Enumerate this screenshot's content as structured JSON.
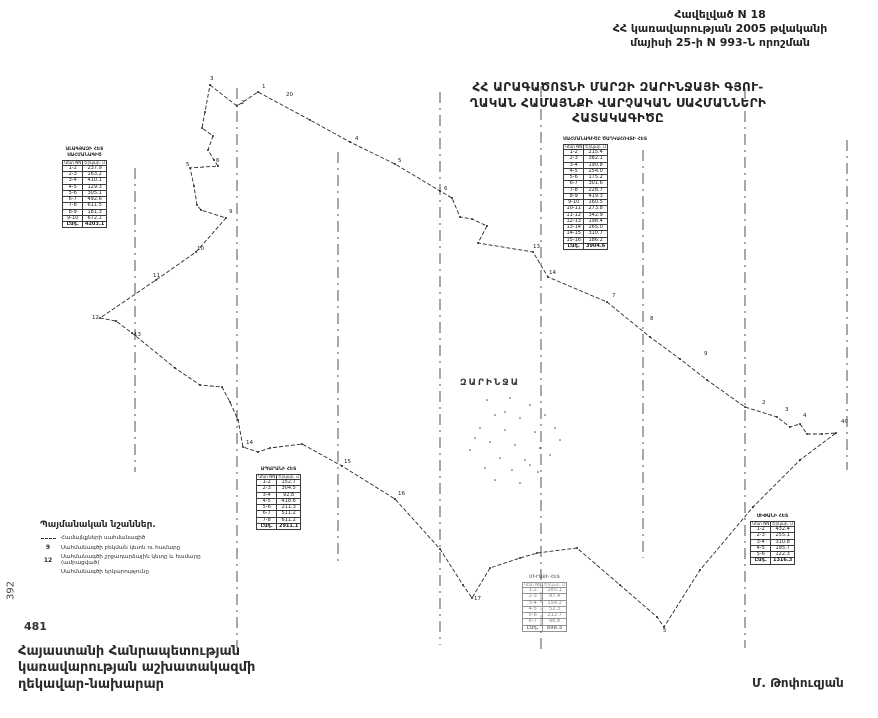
{
  "annex": {
    "line1": "Հավելված N  18",
    "line2": "ՀՀ կառավարության 2005 թվականի",
    "line3": "մայիսի 25-ի N 993-Ն որոշման"
  },
  "title": {
    "line1": "ՀՀ ԱՐԱԳԱԾՈՏՆԻ ՄԱՐԶԻ ԶԱՐԻՆՋԱՅԻ ԳՅՈՒ-",
    "line2": "ՂԱԿԱՆ ՀԱՄԱՅՆՔԻ ՎԱՐՉԱԿԱՆ ՍԱՀՄԱՆՆԵՐԻ",
    "line3": "ՀԱՏԱԿԱԳԻԾԸ"
  },
  "map": {
    "place_label": "ԶԱՐԻՆՋԱ",
    "ink": "#2a2a2a",
    "boundary": [
      [
        210,
        85
      ],
      [
        237,
        106
      ],
      [
        258,
        92
      ],
      [
        310,
        120
      ],
      [
        350,
        142
      ],
      [
        395,
        164
      ],
      [
        440,
        191
      ],
      [
        452,
        198
      ],
      [
        460,
        217
      ],
      [
        472,
        219
      ],
      [
        487,
        226
      ],
      [
        478,
        243
      ],
      [
        533,
        252
      ],
      [
        548,
        277
      ],
      [
        607,
        302
      ],
      [
        650,
        337
      ],
      [
        680,
        359
      ],
      [
        707,
        380
      ],
      [
        745,
        407
      ],
      [
        777,
        417
      ],
      [
        790,
        427
      ],
      [
        800,
        424
      ],
      [
        807,
        434
      ],
      [
        822,
        434
      ],
      [
        836,
        433
      ],
      [
        800,
        460
      ],
      [
        753,
        507
      ],
      [
        700,
        570
      ],
      [
        664,
        627
      ],
      [
        657,
        617
      ],
      [
        620,
        585
      ],
      [
        577,
        548
      ],
      [
        537,
        553
      ],
      [
        520,
        558
      ],
      [
        490,
        568
      ],
      [
        472,
        598
      ],
      [
        463,
        585
      ],
      [
        440,
        549
      ],
      [
        395,
        499
      ],
      [
        342,
        466
      ],
      [
        302,
        444
      ],
      [
        270,
        448
      ],
      [
        258,
        452
      ],
      [
        243,
        447
      ],
      [
        238,
        420
      ],
      [
        230,
        402
      ],
      [
        222,
        387
      ],
      [
        200,
        385
      ],
      [
        175,
        368
      ],
      [
        132,
        333
      ],
      [
        116,
        321
      ],
      [
        100,
        318
      ],
      [
        156,
        280
      ],
      [
        196,
        252
      ],
      [
        226,
        218
      ],
      [
        201,
        210
      ],
      [
        197,
        205
      ],
      [
        194,
        186
      ],
      [
        190,
        168
      ],
      [
        218,
        166
      ],
      [
        214,
        160
      ],
      [
        208,
        150
      ],
      [
        213,
        136
      ],
      [
        202,
        128
      ],
      [
        205,
        112
      ],
      [
        210,
        85
      ]
    ],
    "points": [
      {
        "x": 210,
        "y": 80,
        "l": "3"
      },
      {
        "x": 241,
        "y": 104,
        "l": "2"
      },
      {
        "x": 262,
        "y": 88,
        "l": "1"
      },
      {
        "x": 286,
        "y": 96,
        "l": "20"
      },
      {
        "x": 355,
        "y": 140,
        "l": "4"
      },
      {
        "x": 398,
        "y": 162,
        "l": "5"
      },
      {
        "x": 444,
        "y": 190,
        "l": "6"
      },
      {
        "x": 533,
        "y": 248,
        "l": "13"
      },
      {
        "x": 549,
        "y": 274,
        "l": "14"
      },
      {
        "x": 612,
        "y": 297,
        "l": "7"
      },
      {
        "x": 650,
        "y": 320,
        "l": "8"
      },
      {
        "x": 704,
        "y": 355,
        "l": "9"
      },
      {
        "x": 762,
        "y": 404,
        "l": "2"
      },
      {
        "x": 785,
        "y": 411,
        "l": "3"
      },
      {
        "x": 803,
        "y": 417,
        "l": "4"
      },
      {
        "x": 841,
        "y": 423,
        "l": "40"
      },
      {
        "x": 216,
        "y": 162,
        "l": "6"
      },
      {
        "x": 186,
        "y": 166,
        "l": "5"
      },
      {
        "x": 229,
        "y": 213,
        "l": "9"
      },
      {
        "x": 197,
        "y": 250,
        "l": "10"
      },
      {
        "x": 153,
        "y": 277,
        "l": "11"
      },
      {
        "x": 92,
        "y": 319,
        "l": "12"
      },
      {
        "x": 134,
        "y": 336,
        "l": "13"
      },
      {
        "x": 246,
        "y": 444,
        "l": "14"
      },
      {
        "x": 344,
        "y": 463,
        "l": "15"
      },
      {
        "x": 398,
        "y": 495,
        "l": "16"
      },
      {
        "x": 474,
        "y": 600,
        "l": "17"
      },
      {
        "x": 663,
        "y": 632,
        "l": "5"
      }
    ],
    "fold_lines": [
      {
        "x": 135,
        "y1": 168,
        "y2": 472
      },
      {
        "x": 237,
        "y1": 88,
        "y2": 648
      },
      {
        "x": 338,
        "y1": 152,
        "y2": 562
      },
      {
        "x": 440,
        "y1": 92,
        "y2": 645
      },
      {
        "x": 541,
        "y1": 86,
        "y2": 650
      },
      {
        "x": 643,
        "y1": 150,
        "y2": 558
      },
      {
        "x": 745,
        "y1": 88,
        "y2": 648
      },
      {
        "x": 847,
        "y1": 140,
        "y2": 470
      }
    ],
    "settlement_dots": [
      [
        487,
        400
      ],
      [
        510,
        398
      ],
      [
        530,
        405
      ],
      [
        495,
        415
      ],
      [
        520,
        418
      ],
      [
        545,
        415
      ],
      [
        480,
        428
      ],
      [
        505,
        430
      ],
      [
        535,
        432
      ],
      [
        555,
        428
      ],
      [
        490,
        442
      ],
      [
        515,
        445
      ],
      [
        540,
        448
      ],
      [
        470,
        450
      ],
      [
        500,
        458
      ],
      [
        525,
        460
      ],
      [
        550,
        455
      ],
      [
        485,
        468
      ],
      [
        512,
        470
      ],
      [
        538,
        472
      ],
      [
        495,
        480
      ],
      [
        520,
        483
      ],
      [
        475,
        438
      ],
      [
        560,
        440
      ],
      [
        505,
        412
      ],
      [
        530,
        465
      ]
    ]
  },
  "tables": [
    {
      "x": 62,
      "y": 148,
      "title_lines": [
        "ԱԼԱԳՅԱԶԻ ՀԵՏ",
        "ՍԱՀՄԱՆԱԳԻԾ"
      ],
      "col1": "Կետ NN",
      "col2": "Երկար. մ",
      "faint": false,
      "rows": [
        [
          "1-2",
          "237.9"
        ],
        [
          "2-3",
          "163.2"
        ],
        [
          "3-4",
          "410.1"
        ],
        [
          "4-5",
          "129.3"
        ],
        [
          "5-6",
          "305.1"
        ],
        [
          "6-7",
          "492.6"
        ],
        [
          "7-8",
          "611.5"
        ],
        [
          "8-9",
          "181.3"
        ],
        [
          "9-10",
          "672.1"
        ]
      ],
      "total": [
        "Ընդ.",
        "4203.1"
      ]
    },
    {
      "x": 563,
      "y": 138,
      "title_lines": [
        "ՍԱՀՄԱՆԱԳԻԾԸ ԾԱՂԿԱՀՈՎՏԻ ՀԵՏ"
      ],
      "col1": "Կետ NN",
      "col2": "Երկար. մ",
      "faint": false,
      "rows": [
        [
          "1-2",
          "215.4"
        ],
        [
          "2-3",
          "382.1"
        ],
        [
          "3-4",
          "190.8"
        ],
        [
          "4-5",
          "254.0"
        ],
        [
          "5-6",
          "175.2"
        ],
        [
          "6-7",
          "301.6"
        ],
        [
          "7-8",
          "228.7"
        ],
        [
          "8-9",
          "419.3"
        ],
        [
          "9-10",
          "160.5"
        ],
        [
          "10-11",
          "273.8"
        ],
        [
          "11-12",
          "342.9"
        ],
        [
          "12-13",
          "198.4"
        ],
        [
          "13-14",
          "265.0"
        ],
        [
          "14-15",
          "310.7"
        ],
        [
          "15-16",
          "186.2"
        ]
      ],
      "total": [
        "Ընդ.",
        "3904.6"
      ]
    },
    {
      "x": 256,
      "y": 468,
      "title_lines": [
        "ԱՊԱՐԱՆԻ ՀԵՏ"
      ],
      "col1": "Կետ NN",
      "col2": "Երկար. մ",
      "faint": false,
      "rows": [
        [
          "1-2",
          "152.7"
        ],
        [
          "2-3",
          "304.5"
        ],
        [
          "3-4",
          "92.8"
        ],
        [
          "4-5",
          "418.6"
        ],
        [
          "5-6",
          "211.3"
        ],
        [
          "6-7",
          "511.2"
        ],
        [
          "7-8",
          "611.2"
        ]
      ],
      "total": [
        "Ընդ.",
        "2911.1"
      ]
    },
    {
      "x": 522,
      "y": 576,
      "title_lines": [
        "ՄԻՐԱՔԻ ՀԵՏ"
      ],
      "col1": "Կետ NN",
      "col2": "Երկար. մ",
      "faint": true,
      "rows": [
        [
          "1-2",
          "285.1"
        ],
        [
          "2-3",
          "97.4"
        ],
        [
          "3-4",
          "154.2"
        ],
        [
          "4-5",
          "52.3"
        ],
        [
          "5-6",
          "212.7"
        ],
        [
          "6-7",
          "96.8"
        ]
      ],
      "total": [
        "Ընդ.",
        "898.5"
      ]
    },
    {
      "x": 750,
      "y": 515,
      "title_lines": [
        "ՍԻՓԱՆԻ ՀԵՏ"
      ],
      "col1": "Կետ NN",
      "col2": "Երկար. մ",
      "faint": false,
      "rows": [
        [
          "1-2",
          "432.4"
        ],
        [
          "2-3",
          "255.1"
        ],
        [
          "3-4",
          "310.8"
        ],
        [
          "4-5",
          "195.7"
        ],
        [
          "5-6",
          "122.3"
        ]
      ],
      "total": [
        "Ընդ.",
        "1316.3"
      ]
    }
  ],
  "legend": {
    "title": "Պայմանական նշաններ.",
    "items": [
      {
        "sym": "line",
        "num": "",
        "text": "Համայնքների սահմանագիծ"
      },
      {
        "sym": "num",
        "num": "9",
        "text": "Սահմանագծի բեկման կետն ու համարը"
      },
      {
        "sym": "num",
        "num": "12",
        "text": "Սահմանագծի շրջադարձային կետը և համարը (ամրացված)"
      },
      {
        "sym": "",
        "num": "",
        "text": "Սահմանագծի երկարությունը"
      }
    ]
  },
  "margins": {
    "vertical_number": "392",
    "page_number": "481"
  },
  "footer": {
    "line1": "Հայաստանի Հանրապետության",
    "line2": "կառավարության աշխատակազմի",
    "line3": "ղեկավար-նախարար"
  },
  "signature": "Մ. Թոփուզյան"
}
